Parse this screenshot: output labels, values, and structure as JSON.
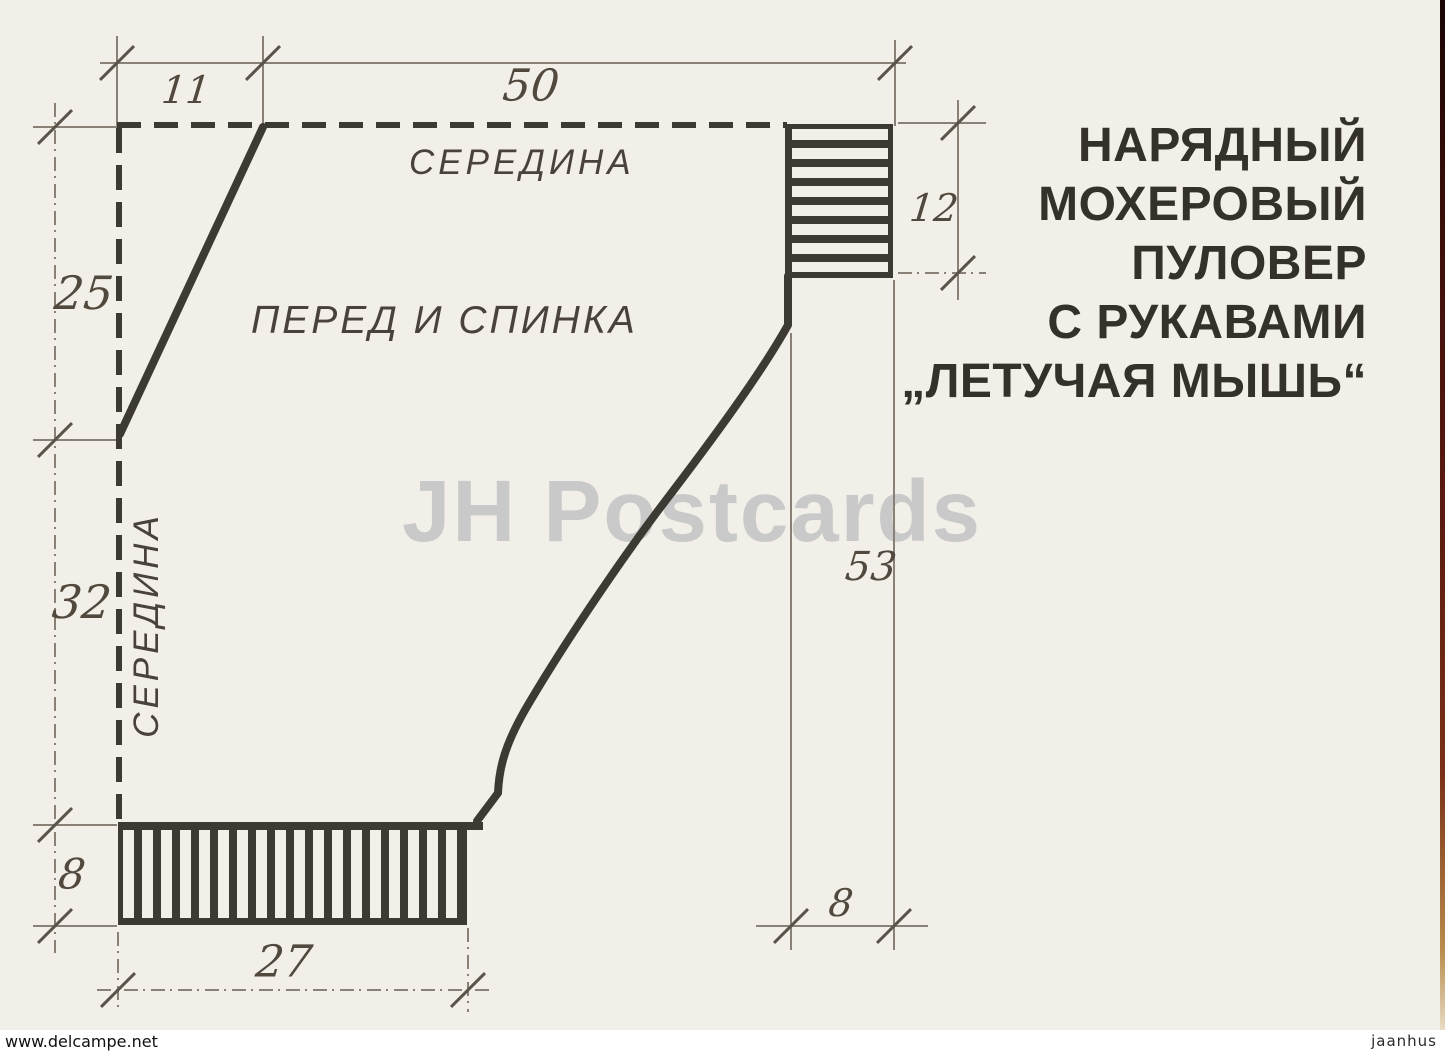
{
  "colors": {
    "paper": "#f2efe8",
    "ink": "#3d3933",
    "dim_line": "#8a8176",
    "number": "#51493d",
    "watermark": "#c9c9c9"
  },
  "title": {
    "lines": [
      "НАРЯДНЫЙ",
      "МОХЕРОВЫЙ",
      "ПУЛОВЕР",
      "С РУКАВАМИ",
      "„ЛЕТУЧАЯ МЫШЬ“"
    ]
  },
  "diagram": {
    "center_top_label": "СЕРЕДИНА",
    "center_left_label": "СЕРЕДИНА",
    "piece_label": "ПЕРЕД И СПИНКА",
    "dims": {
      "neck_width": "11",
      "top_width": "50",
      "neck_depth": "25",
      "cuff_length": "12",
      "side_length": "32",
      "sleeve_length": "53",
      "hem_height": "8",
      "cuff_height": "8",
      "hem_width": "27"
    }
  },
  "watermark": "JH Postcards",
  "footer": {
    "left": "www.delcampe.net",
    "right": "jaanhus"
  }
}
